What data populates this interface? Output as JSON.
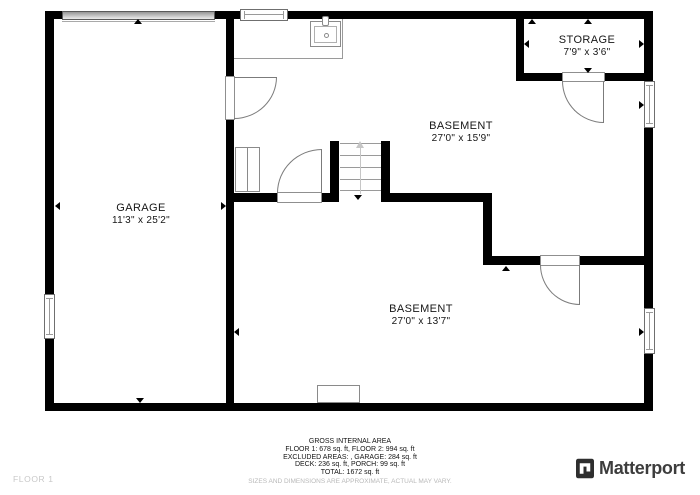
{
  "floor_plan": {
    "floor_label": "FLOOR 1",
    "rooms": [
      {
        "name": "GARAGE",
        "dims": "11'3\" x 25'2\""
      },
      {
        "name": "BASEMENT",
        "dims": "27'0\" x 15'9\""
      },
      {
        "name": "STORAGE",
        "dims": "7'9\" x 3'6\""
      },
      {
        "name": "BASEMENT",
        "dims": "27'0\" x 13'7\""
      }
    ],
    "fixtures": [
      "garage-door",
      "sink",
      "counter",
      "stairs-up",
      "utility-boxes",
      "hearth"
    ]
  },
  "footer": {
    "title": "GROSS INTERNAL AREA",
    "line_floors": "FLOOR 1: 678 sq. ft, FLOOR 2: 994 sq. ft",
    "line_excluded": "EXCLUDED AREAS: , GARAGE: 284 sq. ft",
    "line_deck_porch": "DECK: 236 sq. ft, PORCH: 99 sq. ft",
    "line_total": "TOTAL: 1672 sq. ft",
    "disclaimer": "SIZES AND DIMENSIONS ARE APPROXIMATE, ACTUAL MAY VARY."
  },
  "brand": {
    "name": "Matterport"
  },
  "colors": {
    "wall": "#000000",
    "fixture_outline": "#8a8a8a",
    "muted_text": "#b9b9b9",
    "brand_text": "#3d3d3d"
  }
}
